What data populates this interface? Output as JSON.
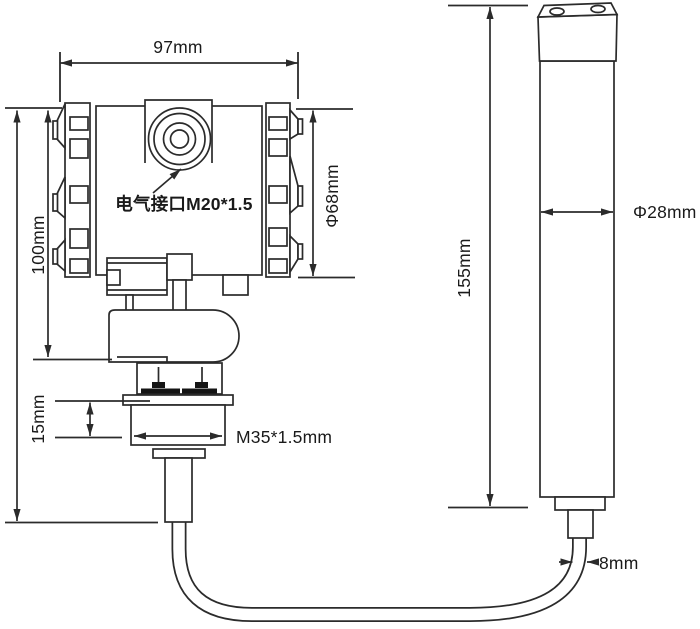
{
  "diagram": {
    "background": "#ffffff",
    "line_color": "#2b2b2b",
    "text_color": "#1a1a1a",
    "labels": {
      "head_width": "97mm",
      "head_height": "100mm",
      "electrical_interface": "电气接口M20*1.5",
      "head_diameter": "Φ68mm",
      "mount_thickness": "15mm",
      "thread_spec": "M35*1.5mm",
      "probe_length": "155mm",
      "probe_diameter": "Φ28mm",
      "cable_diameter": "8mm"
    }
  }
}
